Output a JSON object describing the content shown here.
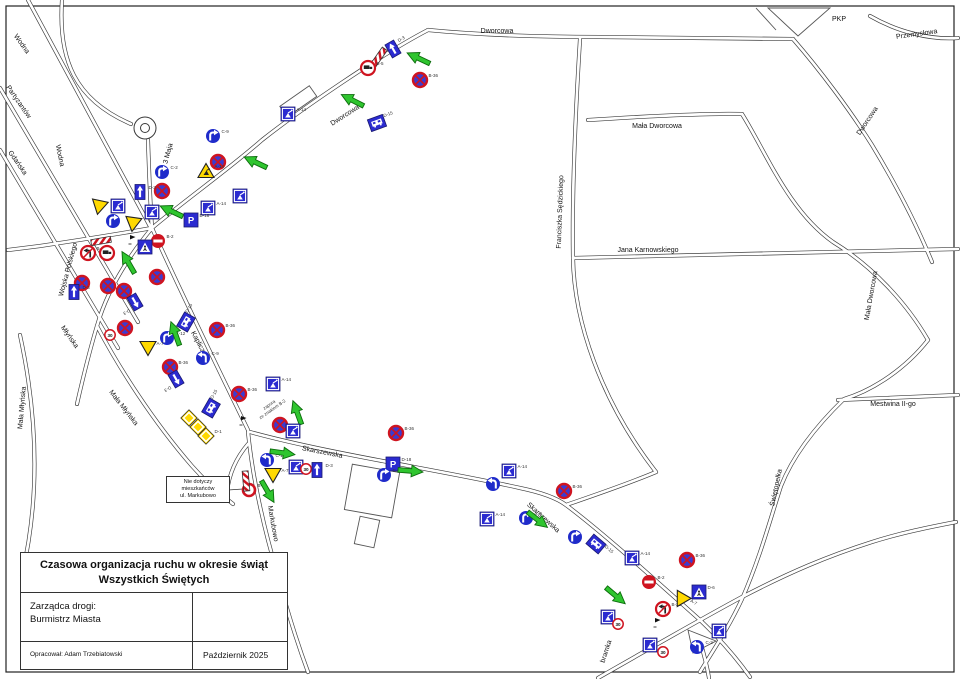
{
  "title_block": {
    "title_line1": "Czasowa organizacja ruchu w okresie świąt",
    "title_line2": "Wszystkich Świętych",
    "manager_label": "Zarządca drogi:",
    "manager_name": "Burmistrz Miasta",
    "author": "Opracował: Adam Trzebiatowski",
    "date": "Październik 2025"
  },
  "note_box": {
    "line1": "Nie dotyczy",
    "line2": "mieszkańców",
    "line3": "ul. Markubowo"
  },
  "annotation": {
    "line1": "zapora",
    "line2": "ze znakiem B-2"
  },
  "colors": {
    "sign_blue": "#2b2bd0",
    "sign_red": "#cf1420",
    "arrow_green": "#2fc52f",
    "triangle_yellow": "#ffd900"
  },
  "streets": [
    {
      "name": "Dworcowa",
      "x": 497,
      "y": 33,
      "r": 0
    },
    {
      "name": "Dworcowa",
      "x": 346,
      "y": 117,
      "r": -33
    },
    {
      "name": "Dworcowa",
      "x": 869,
      "y": 122,
      "r": -56
    },
    {
      "name": "PKP",
      "x": 839,
      "y": 21,
      "r": 0
    },
    {
      "name": "Przemysłowa",
      "x": 917,
      "y": 36,
      "r": -8
    },
    {
      "name": "Mała Dworcowa",
      "x": 657,
      "y": 128,
      "r": 0
    },
    {
      "name": "Mała Dworcowa",
      "x": 873,
      "y": 296,
      "r": -80
    },
    {
      "name": "Jana Karnowskiego",
      "x": 648,
      "y": 252,
      "r": 0
    },
    {
      "name": "Franciszka Sędzickiego",
      "x": 562,
      "y": 212,
      "r": -88
    },
    {
      "name": "Mestwina II-go",
      "x": 893,
      "y": 406,
      "r": 0
    },
    {
      "name": "Świętopełka",
      "x": 778,
      "y": 488,
      "r": -78
    },
    {
      "name": "Skarszewska",
      "x": 322,
      "y": 454,
      "r": 11
    },
    {
      "name": "Skarszewska",
      "x": 542,
      "y": 519,
      "r": 42
    },
    {
      "name": "Kapliczna",
      "x": 198,
      "y": 346,
      "r": 62
    },
    {
      "name": "Markubowo",
      "x": 271,
      "y": 524,
      "r": 80
    },
    {
      "name": "3 Maja",
      "x": 170,
      "y": 154,
      "r": -75
    },
    {
      "name": "Wodna",
      "x": 20,
      "y": 45,
      "r": 55
    },
    {
      "name": "Partyzantów",
      "x": 17,
      "y": 103,
      "r": 55
    },
    {
      "name": "Gdańska",
      "x": 16,
      "y": 164,
      "r": 55
    },
    {
      "name": "Wodna",
      "x": 58,
      "y": 156,
      "r": 78
    },
    {
      "name": "Wojska Polskiego",
      "x": 70,
      "y": 270,
      "r": -75
    },
    {
      "name": "Młyńska",
      "x": 68,
      "y": 338,
      "r": 55
    },
    {
      "name": "Mała Młyńska",
      "x": 122,
      "y": 409,
      "r": 52
    },
    {
      "name": "Mała Młyńska",
      "x": 24,
      "y": 408,
      "r": -85
    },
    {
      "name": "bramka",
      "x": 608,
      "y": 652,
      "r": -72
    }
  ],
  "signs": [
    {
      "t": "d3",
      "x": 393,
      "y": 49,
      "r": -30,
      "l": "D-3"
    },
    {
      "t": "bar",
      "x": 379,
      "y": 57,
      "r": -55
    },
    {
      "t": "ntruck",
      "x": 368,
      "y": 68,
      "l": "B-5"
    },
    {
      "t": "arrow",
      "x": 418,
      "y": 58,
      "r": 205
    },
    {
      "t": "b36",
      "x": 420,
      "y": 80,
      "l": "B-36"
    },
    {
      "t": "arrow",
      "x": 352,
      "y": 100,
      "r": 207
    },
    {
      "t": "bus",
      "x": 377,
      "y": 123,
      "r": -20,
      "l": "D-15"
    },
    {
      "t": "works",
      "x": 288,
      "y": 114,
      "l": "A-14"
    },
    {
      "t": "cR",
      "x": 213,
      "y": 136,
      "l": "C-9"
    },
    {
      "t": "b36",
      "x": 218,
      "y": 162
    },
    {
      "t": "a14",
      "x": 206,
      "y": 171,
      "l": "A-14"
    },
    {
      "t": "arrow",
      "x": 255,
      "y": 162,
      "r": 205
    },
    {
      "t": "works",
      "x": 240,
      "y": 196
    },
    {
      "t": "cR",
      "x": 162,
      "y": 172,
      "l": "C-2"
    },
    {
      "t": "b36",
      "x": 162,
      "y": 191
    },
    {
      "t": "arrow",
      "x": 171,
      "y": 211,
      "r": 205
    },
    {
      "t": "arrow",
      "x": 128,
      "y": 262,
      "r": 240
    },
    {
      "t": "yield",
      "x": 99,
      "y": 207,
      "r": 12
    },
    {
      "t": "works",
      "x": 118,
      "y": 206
    },
    {
      "t": "d3",
      "x": 140,
      "y": 192,
      "l": "D-3"
    },
    {
      "t": "works",
      "x": 152,
      "y": 212
    },
    {
      "t": "cR",
      "x": 113,
      "y": 221
    },
    {
      "t": "yield",
      "x": 133,
      "y": 224,
      "r": 8
    },
    {
      "t": "works",
      "x": 208,
      "y": 208,
      "l": "A-14"
    },
    {
      "t": "park",
      "x": 191,
      "y": 220,
      "l": "D-18"
    },
    {
      "t": "b2",
      "x": 158,
      "y": 241,
      "l": "B-2"
    },
    {
      "t": "cross",
      "x": 145,
      "y": 247
    },
    {
      "t": "bar",
      "x": 101,
      "y": 241,
      "r": -10
    },
    {
      "t": "flag",
      "x": 130,
      "y": 243
    },
    {
      "t": "nturn",
      "x": 88,
      "y": 253,
      "l": "B-21"
    },
    {
      "t": "ntruck",
      "x": 107,
      "y": 253
    },
    {
      "t": "b36",
      "x": 82,
      "y": 283
    },
    {
      "t": "b36",
      "x": 108,
      "y": 286
    },
    {
      "t": "b36",
      "x": 124,
      "y": 291
    },
    {
      "t": "b36",
      "x": 157,
      "y": 277
    },
    {
      "t": "d3",
      "x": 135,
      "y": 302,
      "r": 150,
      "l": "D-3"
    },
    {
      "t": "d3",
      "x": 74,
      "y": 292,
      "l": "D-3"
    },
    {
      "t": "ring",
      "x": 110,
      "y": 335,
      "n": "30",
      "l": "B-33"
    },
    {
      "t": "b36",
      "x": 125,
      "y": 328
    },
    {
      "t": "cR",
      "x": 167,
      "y": 338,
      "l": "C-12"
    },
    {
      "t": "yield",
      "x": 148,
      "y": 348,
      "l": "A-7"
    },
    {
      "t": "arrow",
      "x": 175,
      "y": 333,
      "r": 250
    },
    {
      "t": "bus",
      "x": 186,
      "y": 322,
      "r": -60,
      "l": "D-15"
    },
    {
      "t": "b36",
      "x": 217,
      "y": 330,
      "l": "B-36"
    },
    {
      "t": "cL",
      "x": 203,
      "y": 358,
      "l": "C-9"
    },
    {
      "t": "b36",
      "x": 170,
      "y": 367,
      "l": "B-36"
    },
    {
      "t": "d3",
      "x": 176,
      "y": 379,
      "r": 150,
      "l": "D-3"
    },
    {
      "t": "b36",
      "x": 239,
      "y": 394,
      "l": "B-36"
    },
    {
      "t": "bus",
      "x": 211,
      "y": 408,
      "r": -60,
      "l": "D-15"
    },
    {
      "t": "d1",
      "x": 189,
      "y": 418
    },
    {
      "t": "d1",
      "x": 198,
      "y": 427
    },
    {
      "t": "d1",
      "x": 206,
      "y": 436,
      "l": "D-1"
    },
    {
      "t": "works",
      "x": 273,
      "y": 384,
      "l": "A-14"
    },
    {
      "t": "flag",
      "x": 241,
      "y": 424
    },
    {
      "t": "arrow",
      "x": 297,
      "y": 412,
      "r": 250
    },
    {
      "t": "b36",
      "x": 280,
      "y": 425
    },
    {
      "t": "works",
      "x": 293,
      "y": 431
    },
    {
      "t": "cL",
      "x": 267,
      "y": 460,
      "l": "C-12"
    },
    {
      "t": "arrow",
      "x": 283,
      "y": 453,
      "r": 8
    },
    {
      "t": "yield",
      "x": 273,
      "y": 475,
      "l": "A-7"
    },
    {
      "t": "works",
      "x": 296,
      "y": 467
    },
    {
      "t": "ring",
      "x": 306,
      "y": 469,
      "n": "30"
    },
    {
      "t": "d3",
      "x": 317,
      "y": 470,
      "l": "D-3"
    },
    {
      "t": "b1",
      "x": 249,
      "y": 490,
      "l": "B-1"
    },
    {
      "t": "bar",
      "x": 246,
      "y": 481,
      "r": 85
    },
    {
      "t": "arrow",
      "x": 268,
      "y": 492,
      "r": 60
    },
    {
      "t": "b36",
      "x": 396,
      "y": 433,
      "l": "B-36"
    },
    {
      "t": "park",
      "x": 393,
      "y": 464,
      "l": "D-18"
    },
    {
      "t": "cR",
      "x": 384,
      "y": 475,
      "l": "C-2"
    },
    {
      "t": "arrow",
      "x": 411,
      "y": 471,
      "r": 5
    },
    {
      "t": "cL",
      "x": 493,
      "y": 484
    },
    {
      "t": "works",
      "x": 509,
      "y": 471,
      "l": "A-14"
    },
    {
      "t": "works",
      "x": 487,
      "y": 519,
      "l": "A-14"
    },
    {
      "t": "cR",
      "x": 526,
      "y": 518,
      "l": "C-2"
    },
    {
      "t": "arrow",
      "x": 538,
      "y": 520,
      "r": 38
    },
    {
      "t": "b36",
      "x": 564,
      "y": 491,
      "l": "B-36"
    },
    {
      "t": "cR",
      "x": 575,
      "y": 537
    },
    {
      "t": "bus",
      "x": 596,
      "y": 544,
      "r": 40,
      "l": "D-15"
    },
    {
      "t": "works",
      "x": 632,
      "y": 558,
      "l": "A-14"
    },
    {
      "t": "arrow",
      "x": 616,
      "y": 596,
      "r": 40
    },
    {
      "t": "b2",
      "x": 649,
      "y": 582,
      "l": "B-2"
    },
    {
      "t": "nturn",
      "x": 663,
      "y": 609,
      "l": "B-22"
    },
    {
      "t": "yield",
      "x": 681,
      "y": 600,
      "r": 30,
      "l": "A-7"
    },
    {
      "t": "cross",
      "x": 699,
      "y": 592,
      "l": "D-6"
    },
    {
      "t": "works",
      "x": 608,
      "y": 617
    },
    {
      "t": "ring",
      "x": 618,
      "y": 624,
      "n": "30"
    },
    {
      "t": "flag",
      "x": 655,
      "y": 626
    },
    {
      "t": "works",
      "x": 650,
      "y": 645
    },
    {
      "t": "ring",
      "x": 663,
      "y": 652,
      "n": "30"
    },
    {
      "t": "cL",
      "x": 697,
      "y": 647,
      "l": "C-2"
    },
    {
      "t": "works",
      "x": 719,
      "y": 631
    },
    {
      "t": "b36",
      "x": 687,
      "y": 560,
      "l": "B-36"
    }
  ]
}
